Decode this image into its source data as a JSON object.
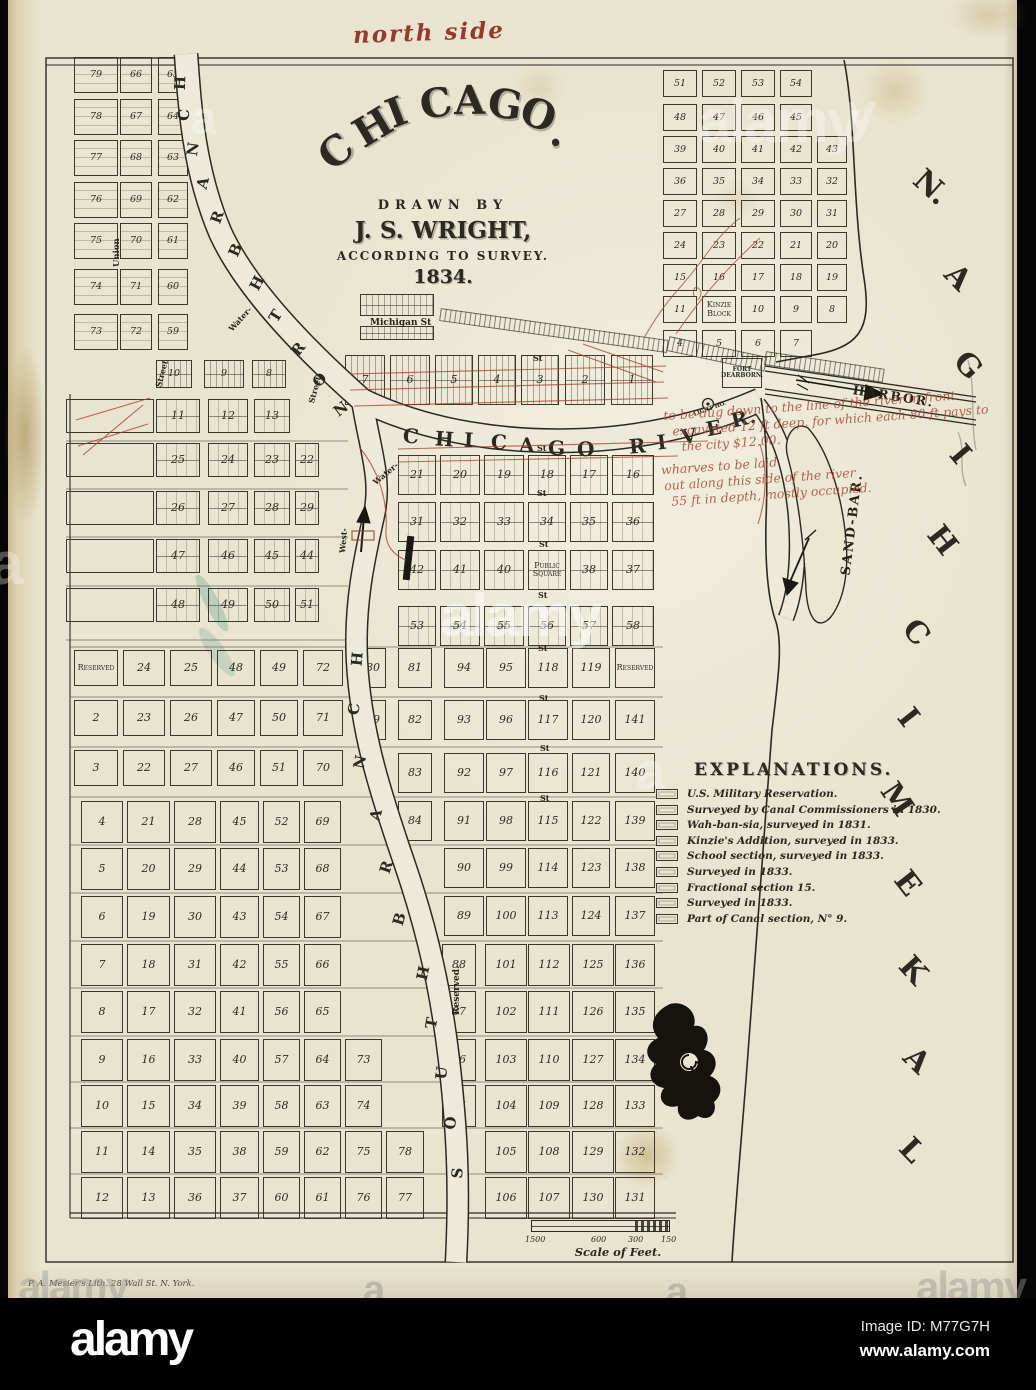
{
  "watermark_bar": {
    "logo": "alamy",
    "image_id": "Image ID: M77G7H",
    "url": "www.alamy.com"
  },
  "watermark": {
    "full": "alamy",
    "letter_a": "a",
    "letter_y": "y"
  },
  "map": {
    "handwriting": {
      "top_note": "north side",
      "harbor_note_lines": [
        "to be dug down to the line of the river in front",
        "excavated 12 ft deep, for which each 80 ft pays to",
        "the city $12.00.",
        "wharves to be laid",
        "out along this side of the river",
        "55 ft in depth, mostly occupied."
      ]
    },
    "title": {
      "arc": "CHICAGO.",
      "drawn_by": "DRAWN BY",
      "author": "J. S. WRIGHT,",
      "survey": "ACCORDING TO SURVEY.",
      "year": "1834."
    },
    "legend": {
      "title": "EXPLANATIONS.",
      "items": [
        "U.S. Military Reservation.",
        "Surveyed by Canal Commissioners in 1830.",
        "Wah-ban-sia, surveyed in 1831.",
        "Kinzie's Addition, surveyed in 1833.",
        "School section, surveyed in 1833.",
        "Surveyed in 1833.",
        "Fractional section 15.",
        "Surveyed in 1833.",
        "Part of Canal section, N° 9."
      ]
    },
    "scale": {
      "caption": "Scale of Feet.",
      "ticks": [
        "1500",
        "600",
        "300",
        "150"
      ]
    },
    "imprint": "P. A. Mesier's Lith. 28 Wall St. N. York.",
    "labels": {
      "lake": "LAKE MICHIGAN.",
      "river": "CHICAGO RIVER.",
      "north_branch": "NORTH BRANCH",
      "south_branch": "SOUTH BRANCH",
      "sand_bar": "SAND-BAR.",
      "harbor": "HARBOR.",
      "fort": "FORT DEARBORN.",
      "light_house": "LIGHT HO.",
      "public_square": "Public Square",
      "reserved": "Reserved",
      "reserved_v": "Reserved.",
      "kinzie_block": "Kinzie Block",
      "michigan_st": "Michigan St",
      "st": "St",
      "street": "Street",
      "union": "Union",
      "water": "Water-",
      "west": "West-"
    },
    "streets": {
      "nw_horizontal": [
        "Free",
        "Trade",
        "Sailors",
        "Right",
        "Owen",
        "Hubbard",
        "Kinzie"
      ],
      "west_horizontal": [
        "Carrol",
        "Fulton",
        "Lake",
        "Randolph",
        "Washington",
        "Madison",
        "Monroe",
        "Adams",
        "Jackson"
      ],
      "west_vertical": [
        "Des Plaines",
        "Jefferson",
        "Clinton",
        "Canal"
      ],
      "ne_horizontal": [
        "Superior",
        "Huron",
        "Erie",
        "Ontario",
        "Ohio",
        "Indiana",
        "Illinois",
        "Michigan"
      ],
      "ne_vertical": [
        "Wolcott",
        "Cass",
        "Rush",
        "Pine",
        "Sand"
      ],
      "central_vertical": [
        "Franklin",
        "Wells",
        "La Salles",
        "Clark",
        "Dearborn",
        "Market"
      ]
    },
    "grids": {
      "nw": [
        [
          "79",
          "66",
          "65"
        ],
        [
          "78",
          "67",
          "64"
        ],
        [
          "77",
          "68",
          "63"
        ],
        [
          "76",
          "69",
          "62"
        ],
        [
          "75",
          "70",
          "61"
        ],
        [
          "74",
          "71",
          "60"
        ],
        [
          "73",
          "72",
          "59"
        ]
      ],
      "kinzie_row": [
        [
          "10",
          "9",
          "8"
        ]
      ],
      "west": [
        [
          "11",
          "12",
          "13"
        ],
        [
          "25",
          "24",
          "23",
          "22"
        ],
        [
          "26",
          "27",
          "28",
          "29"
        ],
        [
          "47",
          "46",
          "45",
          "44"
        ],
        [
          "48",
          "49",
          "50",
          "51"
        ]
      ],
      "left_empty": [
        [
          ""
        ],
        [
          ""
        ],
        [
          ""
        ],
        [
          ""
        ],
        [
          ""
        ]
      ],
      "reserved_w": [
        [
          "Reserved",
          "24",
          "25",
          "48",
          "49",
          "72"
        ],
        [
          "2",
          "23",
          "26",
          "47",
          "50",
          "71"
        ],
        [
          "3",
          "22",
          "27",
          "46",
          "51",
          "70"
        ]
      ],
      "bottom": [
        [
          "4",
          "21",
          "28",
          "45",
          "52",
          "69"
        ],
        [
          "5",
          "20",
          "29",
          "44",
          "53",
          "68"
        ],
        [
          "6",
          "19",
          "30",
          "43",
          "54",
          "67"
        ],
        [
          "7",
          "18",
          "31",
          "42",
          "55",
          "66"
        ],
        [
          "8",
          "17",
          "32",
          "41",
          "56",
          "65"
        ],
        [
          "9",
          "16",
          "33",
          "40",
          "57",
          "64",
          "73"
        ],
        [
          "10",
          "15",
          "34",
          "39",
          "58",
          "63",
          "74"
        ],
        [
          "11",
          "14",
          "35",
          "38",
          "59",
          "62",
          "75",
          "78"
        ],
        [
          "12",
          "13",
          "36",
          "37",
          "60",
          "61",
          "76",
          "77"
        ]
      ],
      "east_a": [
        [
          "80",
          "81",
          "94",
          "95",
          "118",
          "119",
          "Reserved"
        ],
        [
          "79",
          "82",
          "93",
          "96",
          "117",
          "120",
          "141"
        ],
        [
          "",
          "83",
          "92",
          "97",
          "116",
          "121",
          "140"
        ],
        [
          "",
          "84",
          "91",
          "98",
          "115",
          "122",
          "139"
        ],
        [
          "",
          "",
          "90",
          "99",
          "114",
          "123",
          "138"
        ],
        [
          "",
          "",
          "89",
          "100",
          "113",
          "124",
          "137"
        ]
      ],
      "east_b": [
        [
          "88",
          "101",
          "112",
          "125",
          "136"
        ],
        [
          "87",
          "102",
          "111",
          "126",
          "135"
        ],
        [
          "86",
          "103",
          "110",
          "127",
          "134"
        ],
        [
          "85",
          "104",
          "109",
          "128",
          "133"
        ],
        [
          "",
          "105",
          "108",
          "129",
          "132"
        ],
        [
          "",
          "106",
          "107",
          "130",
          "131"
        ]
      ],
      "central": [
        [
          "21",
          "20",
          "19",
          "18",
          "17",
          "16"
        ],
        [
          "31",
          "32",
          "33",
          "34",
          "35",
          "36"
        ],
        [
          "42",
          "41",
          "40",
          "Public Square",
          "38",
          "37"
        ],
        [
          "53",
          "54",
          "55",
          "56",
          "57",
          "58"
        ]
      ],
      "north_bank": [
        [
          "7",
          "6",
          "5",
          "4",
          "3",
          "2",
          "1"
        ]
      ],
      "ne": [
        [
          "51",
          "52",
          "53",
          "54"
        ],
        [
          "48",
          "47",
          "46",
          "45"
        ],
        [
          "39",
          "40",
          "41",
          "42",
          "43"
        ],
        [
          "36",
          "35",
          "34",
          "33",
          "32"
        ],
        [
          "27",
          "28",
          "29",
          "30",
          "31"
        ],
        [
          "24",
          "23",
          "22",
          "21",
          "20"
        ],
        [
          "15",
          "16",
          "17",
          "18",
          "19"
        ],
        [
          "11",
          "Kinzie Block",
          "10",
          "9",
          "8"
        ],
        [
          "4",
          "5",
          "6",
          "7"
        ]
      ]
    }
  }
}
